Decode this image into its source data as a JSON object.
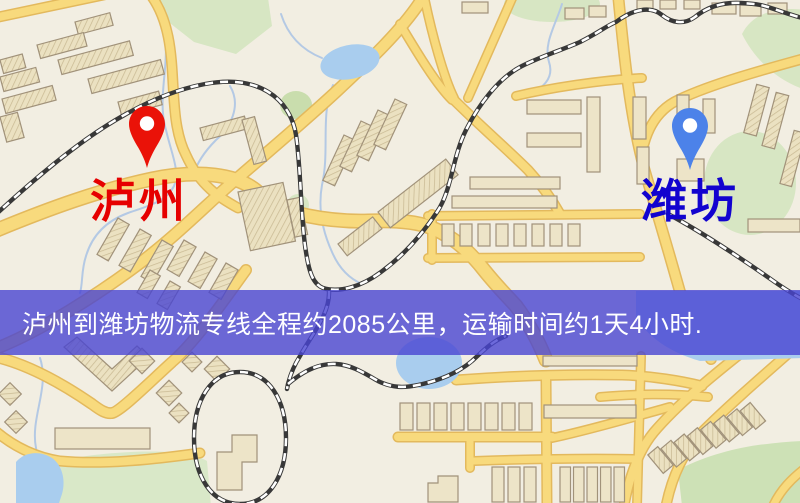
{
  "banner": {
    "text": "泸州到潍坊物流专线全程约2085公里，运输时间约1天4小时.",
    "background": "rgba(72,69,210,0.80)",
    "text_color": "#ffffff"
  },
  "markers": {
    "origin": {
      "label": "泸州",
      "label_color": "#e60000",
      "pin_color": "#ea1208",
      "pin_hole_color": "#ffffff"
    },
    "destination": {
      "label": "潍坊",
      "label_color": "#1203cf",
      "pin_color": "#4c82e9",
      "pin_hole_color": "#ffffff"
    }
  },
  "map": {
    "background_color": "#f2eee2",
    "road_color": "#f8da7d",
    "railway_color": "#383838",
    "water_color": "#a9cdee",
    "green_color": "#d7e6c3",
    "building_color": "#ede4c8"
  }
}
